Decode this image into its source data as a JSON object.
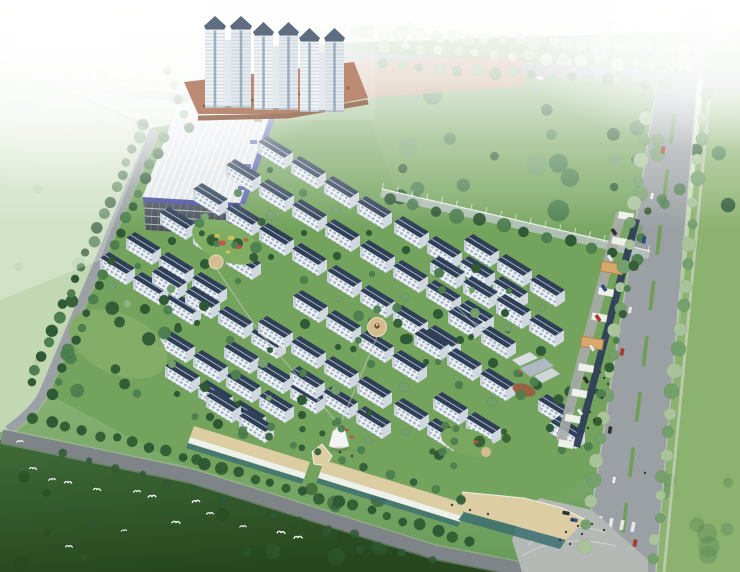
{
  "meta": {
    "title": "Residential community master-plan aerial rendering",
    "description": "Bird's-eye architectural rendering of a residential development: rows of white slab apartment buildings with dark slate roofs, three pairs of high-rise towers on a brick podium, a large factory hall with a ribbed silver roof and purple fascia, tree-lined perimeter roads, a commercial strip with tan canopies, green lawns, a dark field with white egrets, all fading into white haze at the top."
  },
  "palette": {
    "hazeWhite": "#f6f9f4",
    "baseTop": "#f2f7ee",
    "baseMid": "#c3d9b2",
    "baseLow": "#8fb87b",
    "baseBottom": "#679a58",
    "innerGreen": "#74a35e",
    "lawnSE": "#8bb26f",
    "greenNE": "#7aa763",
    "fieldLeft": "#c2d8b2",
    "fieldSWTop": "#3f6b38",
    "fieldSWBottom": "#27481f",
    "road": "#9aa0a3",
    "roadDark": "#7e8487",
    "roadEdge": "#c9ccc9",
    "plaza": "#b5b9b6",
    "roofSlate": "#2e3f57",
    "ridge": "#c8d4de",
    "facade": "#edf1f5",
    "facadeShade": "#c3ccd6",
    "windowBlue": "#8fa3b4",
    "gableEnd": "#cfd7df",
    "towerWhite": "#eef2f5",
    "towerShade": "#dfe6ec",
    "towerCap": "#44556b",
    "towerGlass": "#7e98ad",
    "brick": "#b0795c",
    "brickDark": "#8f5f47",
    "brickEast": "#c08a6a",
    "factoryRoof": "#e2e6e9",
    "factoryRib": "#f7f9fa",
    "fascia": "#5d63b0",
    "factoryFacade": "#49545f",
    "parapet": "#4a4f9f",
    "mullion": "#a8876a",
    "floorLine": "#c8ccd0",
    "fence": "#b9c6bf",
    "fenceTop": "#e9efe9",
    "canopyTan": "#dccda2",
    "canopyWhite": "#eef0ea",
    "gateTan": "#d9a96b",
    "gateEdge": "#b3814a",
    "shopGlass": "#3d6e72",
    "laneGrey": "#a7aba8",
    "median": "#6f9e58",
    "treeDark": "#2f5a35",
    "treeMid": "#4d7f4f",
    "treeLight": "#74a06b",
    "treePale": "#a9c49b",
    "treePaler": "#c6d8ba",
    "palm": "#356033",
    "plazaTan": "#d4bc8e",
    "playground": "#9a5b40",
    "flowerRed": "#c2504a",
    "flowerYellow": "#d8c35a",
    "bird": "#ffffff",
    "carRed": "#b7352c",
    "carBlue": "#2f4e8f",
    "carWhite": "#e8e8e6",
    "carDark": "#30302e",
    "person": "#2e3138"
  },
  "scene": {
    "regions": [
      {
        "name": "haze-sky",
        "desc": "white atmospheric haze across the top"
      },
      {
        "name": "northeast-greenbelt",
        "desc": "tree-filled green area behind boundary fence"
      },
      {
        "name": "east-lawn",
        "desc": "large plain lawn east of the avenue"
      },
      {
        "name": "southwest-field",
        "desc": "dark green field with white egrets"
      },
      {
        "name": "apartment-area",
        "desc": "diagonal grid of slab apartment rows with courtyard trees"
      },
      {
        "name": "tower-cluster",
        "desc": "three pairs of high-rise towers on brick podium"
      },
      {
        "name": "factory-hall",
        "desc": "large industrial hall with ribbed roof and purple fascia"
      },
      {
        "name": "south-commercial",
        "desc": "tan-canopy shop strip along south road"
      },
      {
        "name": "east-commercial",
        "desc": "white-canopy shop strip and gates along east avenue"
      }
    ],
    "apartment_rows": [
      [
        258,
        142,
        4
      ],
      [
        226,
        165,
        4
      ],
      [
        193,
        189,
        4
      ],
      [
        160,
        213,
        3
      ],
      [
        394,
        222,
        4
      ],
      [
        360,
        246,
        4
      ],
      [
        327,
        271,
        4
      ],
      [
        293,
        296,
        4
      ],
      [
        464,
        240,
        3
      ],
      [
        430,
        262,
        3
      ],
      [
        496,
        300,
        2
      ],
      [
        448,
        312,
        2
      ],
      [
        414,
        334,
        3
      ],
      [
        126,
        238,
        3
      ],
      [
        100,
        258,
        3
      ],
      [
        152,
        272,
        4
      ],
      [
        258,
        322,
        4
      ],
      [
        224,
        347,
        3
      ],
      [
        160,
        336,
        4
      ],
      [
        165,
        366,
        3
      ],
      [
        290,
        372,
        3
      ],
      [
        433,
        398,
        2
      ],
      [
        394,
        404,
        2
      ],
      [
        206,
        396,
        2
      ],
      [
        538,
        400,
        1
      ],
      [
        550,
        422,
        1
      ]
    ],
    "tree_lines": [
      {
        "p": [
          386,
          46,
          688,
          68
        ],
        "gap": 17,
        "r": 5,
        "c": "treePale",
        "c2": "treePaler",
        "o": 0.9,
        "j": 2
      },
      {
        "p": [
          382,
          64,
          664,
          84
        ],
        "gap": 18,
        "r": 5,
        "c": "treeMid",
        "c2": "treeLight",
        "o": 0.95,
        "j": 2
      },
      {
        "p": [
          320,
          30,
          700,
          50
        ],
        "gap": 16,
        "r": 6,
        "c": "treePaler",
        "c2": "treePale",
        "o": 0.8,
        "j": 3
      },
      {
        "p": [
          144,
          124,
          30,
          382
        ],
        "gap": 14,
        "r": 5,
        "c": "treeDark",
        "c2": "treeMid",
        "o": 1,
        "j": 2
      },
      {
        "p": [
          162,
          138,
          52,
          394
        ],
        "gap": 14,
        "r": 4.5,
        "c": "treeMid",
        "c2": "treeDark",
        "o": 1,
        "j": 2
      },
      {
        "p": [
          34,
          418,
          198,
          460
        ],
        "gap": 16,
        "r": 5,
        "c": "palm",
        "c2": "treeDark",
        "o": 1,
        "j": 2
      },
      {
        "p": [
          204,
          464,
          470,
          540
        ],
        "gap": 17,
        "r": 5,
        "c": "treeDark",
        "c2": "palm",
        "o": 1,
        "j": 2
      },
      {
        "p": [
          64,
          452,
          430,
          560
        ],
        "gap": 26,
        "r": 3.5,
        "c": "treeDark",
        "c2": "treeDark",
        "o": 0.85,
        "j": 3
      },
      {
        "p": [
          650,
          96,
          584,
          546
        ],
        "gap": 21,
        "r": 6,
        "c": "treeLight",
        "c2": "treePale",
        "o": 1,
        "j": 2
      },
      {
        "p": [
          706,
          96,
          654,
          560
        ],
        "gap": 21,
        "r": 6,
        "c": "treeLight",
        "c2": "treePale",
        "o": 1,
        "j": 2
      },
      {
        "p": [
          392,
          200,
          636,
          258
        ],
        "gap": 22,
        "r": 6,
        "c": "treeDark",
        "c2": "treeMid",
        "o": 1,
        "j": 2
      },
      {
        "p": [
          648,
          212,
          590,
          446
        ],
        "gap": 26,
        "r": 4,
        "c": "palm",
        "c2": "treeMid",
        "o": 1,
        "j": 2
      },
      {
        "p": [
          196,
          416,
          462,
          498
        ],
        "gap": 24,
        "r": 4,
        "c": "treeMid",
        "c2": "treeDark",
        "o": 0.9,
        "j": 2
      },
      {
        "p": [
          168,
          70,
          190,
          128
        ],
        "gap": 15,
        "r": 4,
        "c": "treeDark",
        "c2": "treeMid",
        "o": 0.9,
        "j": 1
      },
      {
        "p": [
          10,
          64,
          250,
          96
        ],
        "gap": 18,
        "r": 5,
        "c": "treePaler",
        "c2": "treePale",
        "o": 0.6,
        "j": 2
      }
    ],
    "tree_clusters": [
      {
        "x": 400,
        "y": 64,
        "w": 330,
        "h": 150,
        "n": 30,
        "r0": 4,
        "r1": 11,
        "cs": [
          "treeDark",
          "treeMid",
          "treeLight"
        ],
        "o": 0.95
      },
      {
        "x": 300,
        "y": 24,
        "w": 430,
        "h": 46,
        "n": 18,
        "r0": 4,
        "r1": 9,
        "cs": [
          "treePale",
          "treePaler"
        ],
        "o": 0.9
      },
      {
        "x": 0,
        "y": 470,
        "w": 430,
        "h": 100,
        "n": 24,
        "r0": 3,
        "r1": 9,
        "cs": [
          "fieldSWBottom",
          "treeDark"
        ],
        "o": 0.55
      },
      {
        "x": 645,
        "y": 470,
        "w": 95,
        "h": 100,
        "n": 9,
        "r0": 5,
        "r1": 11,
        "cs": [
          "treeMid"
        ],
        "o": 0.3
      },
      {
        "x": 12,
        "y": 120,
        "w": 120,
        "h": 250,
        "n": 12,
        "r0": 3,
        "r1": 7,
        "cs": [
          "treePale"
        ],
        "o": 0.5
      },
      {
        "x": 196,
        "y": 214,
        "w": 66,
        "h": 52,
        "n": 9,
        "r0": 3,
        "r1": 6,
        "cs": [
          "treeDark",
          "treeMid"
        ],
        "o": 0.95
      },
      {
        "x": 346,
        "y": 306,
        "w": 68,
        "h": 44,
        "n": 7,
        "r0": 3,
        "r1": 5.5,
        "cs": [
          "treeMid",
          "treeDark"
        ],
        "o": 0.95
      },
      {
        "x": 505,
        "y": 352,
        "w": 92,
        "h": 52,
        "n": 9,
        "r0": 3,
        "r1": 6,
        "cs": [
          "treeDark",
          "treeMid"
        ],
        "o": 0.95
      },
      {
        "x": 432,
        "y": 424,
        "w": 88,
        "h": 44,
        "n": 8,
        "r0": 3,
        "r1": 6,
        "cs": [
          "treeMid",
          "palm"
        ],
        "o": 0.95
      },
      {
        "x": 300,
        "y": 414,
        "w": 62,
        "h": 40,
        "n": 6,
        "r0": 3,
        "r1": 5,
        "cs": [
          "treeDark",
          "treeMid"
        ],
        "o": 0.95
      },
      {
        "x": 60,
        "y": 292,
        "w": 132,
        "h": 104,
        "n": 14,
        "r0": 3.5,
        "r1": 7,
        "cs": [
          "treeDark",
          "treeMid"
        ],
        "o": 0.95
      },
      {
        "x": 620,
        "y": 120,
        "w": 60,
        "h": 110,
        "n": 10,
        "r0": 4,
        "r1": 8,
        "cs": [
          "treeMid",
          "treeLight"
        ],
        "o": 0.85
      }
    ],
    "birds": [
      [
        20,
        442
      ],
      [
        33,
        469
      ],
      [
        52,
        480
      ],
      [
        68,
        483
      ],
      [
        97,
        490
      ],
      [
        137,
        492
      ],
      [
        152,
        497
      ],
      [
        196,
        502
      ],
      [
        176,
        523
      ],
      [
        124,
        531
      ],
      [
        69,
        547
      ],
      [
        210,
        514
      ],
      [
        243,
        527
      ],
      [
        281,
        533
      ],
      [
        298,
        538
      ]
    ],
    "cars": [
      [
        663,
        150,
        100,
        "carRed"
      ],
      [
        652,
        196,
        100,
        "carWhite"
      ],
      [
        644,
        240,
        100,
        "carBlue"
      ],
      [
        630,
        310,
        100,
        "carWhite"
      ],
      [
        622,
        352,
        100,
        "carRed"
      ],
      [
        610,
        430,
        100,
        "carDark"
      ],
      [
        635,
        543,
        100,
        "carRed"
      ],
      [
        614,
        480,
        100,
        "carWhite"
      ],
      [
        614,
        232,
        55,
        "carDark"
      ],
      [
        610,
        258,
        55,
        "carWhite"
      ],
      [
        604,
        288,
        55,
        "carBlue"
      ],
      [
        598,
        318,
        55,
        "carRed"
      ],
      [
        592,
        348,
        55,
        "carWhite"
      ],
      [
        586,
        380,
        55,
        "carDark"
      ],
      [
        580,
        412,
        55,
        "carWhite"
      ],
      [
        566,
        513,
        10,
        "carDark"
      ],
      [
        574,
        520,
        10,
        "carBlue"
      ],
      [
        540,
        78,
        8,
        "carWhite"
      ]
    ],
    "people": [
      [
        600,
        372
      ],
      [
        604,
        378
      ],
      [
        608,
        384
      ],
      [
        597,
        390
      ],
      [
        602,
        398
      ],
      [
        590,
        412
      ],
      [
        594,
        420
      ],
      [
        588,
        428
      ],
      [
        572,
        520
      ],
      [
        578,
        526
      ],
      [
        566,
        532
      ],
      [
        560,
        540
      ],
      [
        570,
        544
      ],
      [
        582,
        534
      ],
      [
        592,
        524
      ],
      [
        604,
        530
      ],
      [
        645,
        473
      ],
      [
        452,
        505
      ],
      [
        470,
        510
      ],
      [
        488,
        514
      ],
      [
        340,
        452
      ],
      [
        352,
        456
      ]
    ],
    "flowers": [
      [
        222,
        243,
        4,
        "flowerRed"
      ],
      [
        231,
        238,
        3.5,
        "flowerYellow"
      ],
      [
        239,
        247,
        3,
        "flowerRed"
      ],
      [
        228,
        252,
        2.5,
        "flowerYellow"
      ],
      [
        217,
        236,
        3,
        "flowerYellow"
      ],
      [
        246,
        240,
        2.5,
        "flowerRed"
      ],
      [
        352,
        437,
        2.5,
        "flowerRed"
      ],
      [
        347,
        430,
        2,
        "flowerRed"
      ],
      [
        476,
        442,
        2.5,
        "flowerRed"
      ],
      [
        520,
        372,
        2,
        "flowerRed"
      ]
    ],
    "median": {
      "x1": 676,
      "y1": 100,
      "x2": 621,
      "y2": 548,
      "len": 30,
      "step": 56,
      "w": 3.6
    },
    "crosswalk": [
      [
        589,
        519
      ],
      [
        600,
        521
      ],
      [
        611,
        523
      ],
      [
        622,
        525
      ],
      [
        633,
        527
      ]
    ],
    "canopies_east": {
      "x1": 626,
      "y1": 216,
      "x2": 566,
      "y2": 444,
      "n": 10,
      "w": 15,
      "h": 7,
      "rot": 10
    },
    "gates": [
      [
        612,
        268
      ],
      [
        592,
        343
      ]
    ],
    "fence_posts": {
      "x1": 382,
      "y1": 190,
      "x2": 648,
      "y2": 252,
      "n": 19
    },
    "podium_arches": {
      "x1": 204,
      "y1": 106,
      "x2": 348,
      "y2": 88,
      "n": 13
    },
    "towers": [
      {
        "x": 205,
        "top": 16,
        "w": 46,
        "base": 108
      },
      {
        "x": 254,
        "top": 22,
        "w": 44,
        "base": 110
      },
      {
        "x": 300,
        "top": 28,
        "w": 44,
        "base": 112
      }
    ]
  }
}
